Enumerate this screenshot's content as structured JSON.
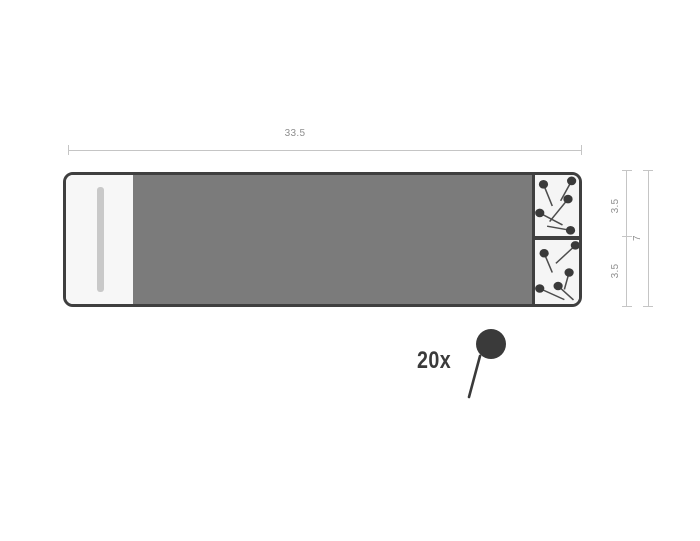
{
  "dimensions": {
    "width": {
      "value": "33.5"
    },
    "compartment_top": {
      "value": "3.5"
    },
    "compartment_bottom": {
      "value": "3.5"
    },
    "total_height": {
      "value": "7"
    }
  },
  "quantity": {
    "label": "20x"
  },
  "colors": {
    "board": "#7b7b7b",
    "outline": "#3f3f3f",
    "pin": "#3a3a3a",
    "needle": "#4d4d4d",
    "dimension_line": "#c5c5c5",
    "dimension_text": "#8f8f8f",
    "tray_bg": "#f7f7f7",
    "compartment_bg": "#f5f5f5",
    "pen_bar": "#c9c9c9"
  },
  "pins": {
    "head_radius": 4.2,
    "top_compartment": [
      {
        "head": [
          7.7,
          9
        ],
        "tip": [
          15.7,
          30
        ]
      },
      {
        "head": [
          33.3,
          5.7
        ],
        "tip": [
          23.3,
          25
        ]
      },
      {
        "head": [
          30,
          23.3
        ],
        "tip": [
          13.3,
          45
        ]
      },
      {
        "head": [
          4.3,
          36.7
        ],
        "tip": [
          25,
          48.3
        ]
      },
      {
        "head": [
          32.3,
          53.5
        ],
        "tip": [
          11,
          49.5
        ]
      }
    ],
    "bottom_compartment": [
      {
        "head": [
          8.3,
          13
        ],
        "tip": [
          15.7,
          32
        ]
      },
      {
        "head": [
          36.7,
          5.3
        ],
        "tip": [
          19,
          23
        ]
      },
      {
        "head": [
          31,
          32
        ],
        "tip": [
          26.7,
          48.7
        ]
      },
      {
        "head": [
          21,
          45.3
        ],
        "tip": [
          35,
          59
        ]
      },
      {
        "head": [
          4.3,
          47.7
        ],
        "tip": [
          26.7,
          58.7
        ]
      }
    ]
  }
}
